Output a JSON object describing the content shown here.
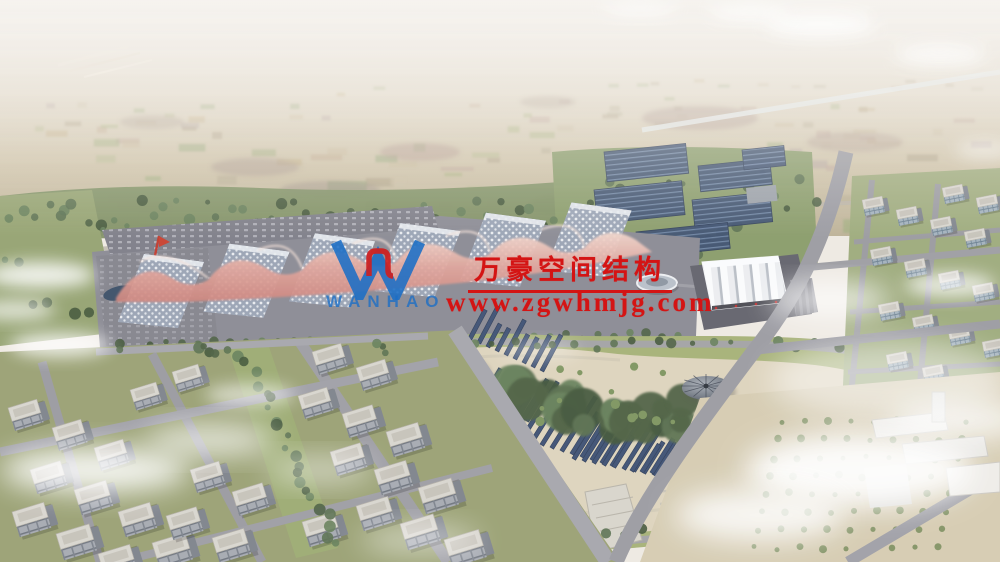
{
  "image": {
    "kind_label": "aerial-architectural-rendering",
    "subject_label": "exhibition-center-campus"
  },
  "watermark": {
    "logo_icon": "wanhao-w-logo",
    "logo_text": "WANHAO",
    "company_name": "万豪空间结构",
    "website": "www.zgwhmjg.com",
    "text_color": "#d41414",
    "logo_color": "#1b6ec6",
    "logo_emblem_color": "#cf1f1f"
  }
}
